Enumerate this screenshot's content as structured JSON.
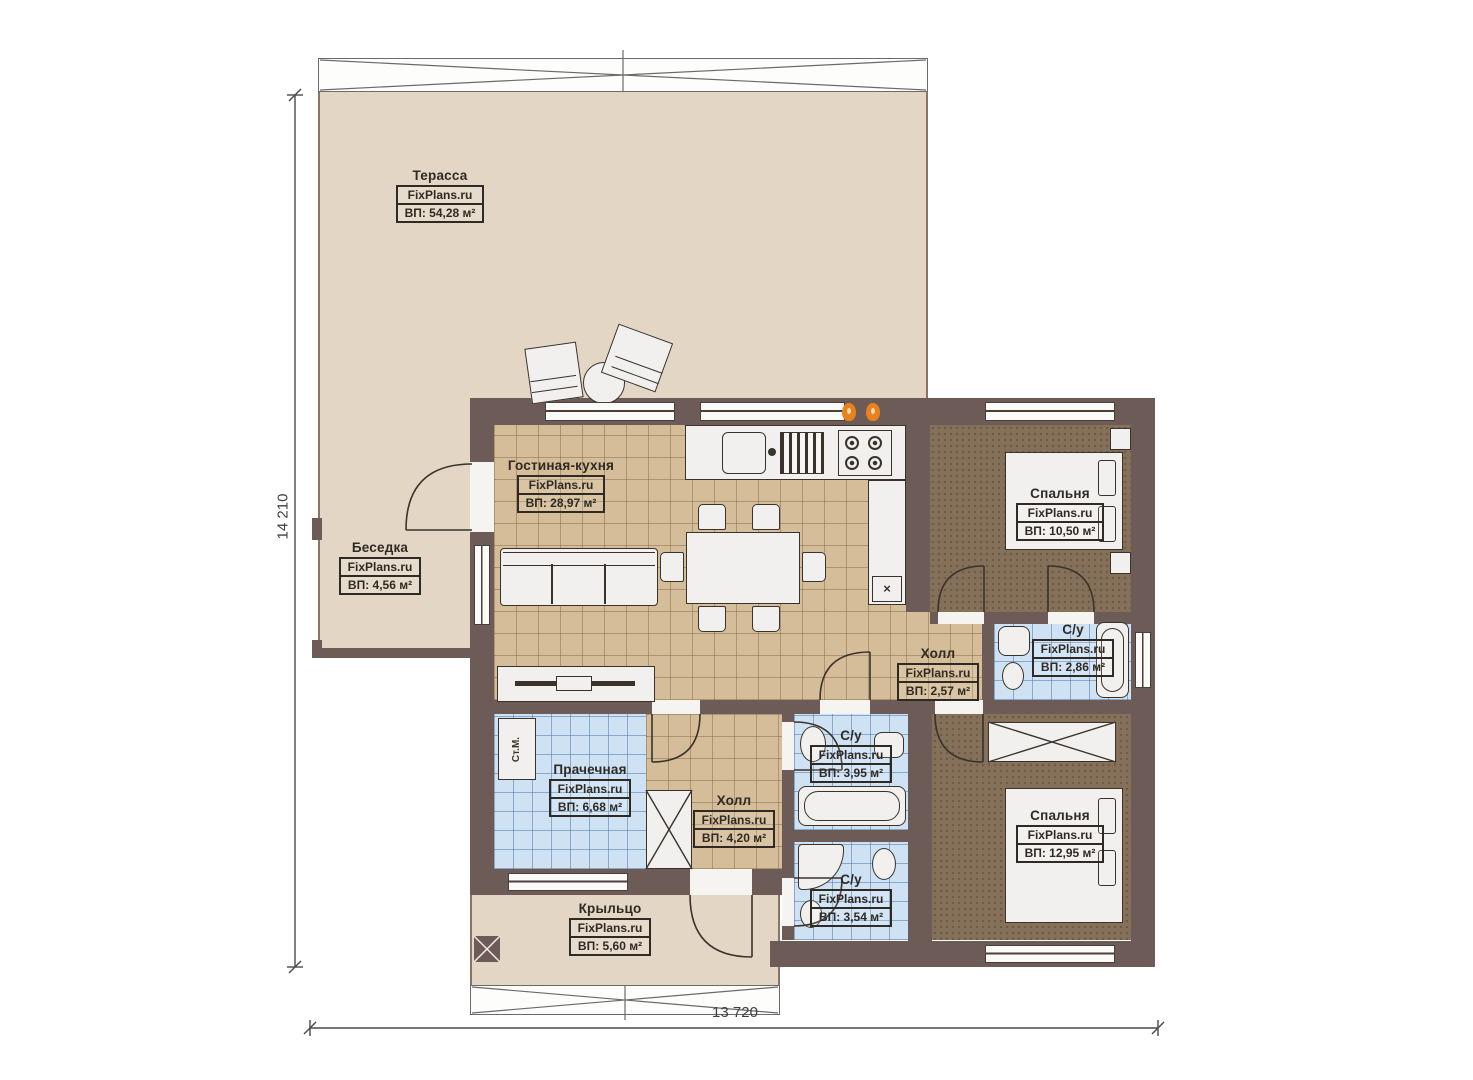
{
  "plan": {
    "dimensions": {
      "height_label": "14 210",
      "width_label": "13 720"
    },
    "rooms": {
      "terrace": {
        "name": "Терасса",
        "brand": "FixPlans.ru",
        "area": "ВП: 54,28 м²"
      },
      "gazebo": {
        "name": "Беседка",
        "brand": "FixPlans.ru",
        "area": "ВП: 4,56 м²"
      },
      "living_kitchen": {
        "name": "Гостиная-кухня",
        "brand": "FixPlans.ru",
        "area": "ВП: 28,97 м²"
      },
      "bedroom_top": {
        "name": "Спальня",
        "brand": "FixPlans.ru",
        "area": "ВП: 10,50 м²"
      },
      "hall_top": {
        "name": "Холл",
        "brand": "FixPlans.ru",
        "area": "ВП: 2,57 м²"
      },
      "bathroom_top": {
        "name": "С/у",
        "brand": "FixPlans.ru",
        "area": "ВП: 2,86 м²"
      },
      "laundry": {
        "name": "Прачечная",
        "brand": "FixPlans.ru",
        "area": "ВП: 6,68 м²"
      },
      "hall_bottom": {
        "name": "Холл",
        "brand": "FixPlans.ru",
        "area": "ВП: 4,20 м²"
      },
      "bathroom_mid": {
        "name": "С/у",
        "brand": "FixPlans.ru",
        "area": "ВП: 3,95 м²"
      },
      "bathroom_low": {
        "name": "С/у",
        "brand": "FixPlans.ru",
        "area": "ВП: 3,54 м²"
      },
      "bedroom_bottom": {
        "name": "Спальня",
        "brand": "FixPlans.ru",
        "area": "ВП: 12,95 м²"
      },
      "porch": {
        "name": "Крыльцо",
        "brand": "FixPlans.ru",
        "area": "ВП: 5,60 м²"
      }
    },
    "annotations": {
      "washing_machine": "Ст.М."
    },
    "colors": {
      "wall": "#6d5b57",
      "terrace_floor": "#e4d6c4",
      "living_floor": "#d4bd98",
      "bedroom_floor": "#85705a",
      "bathroom_floor": "#cfe2f4",
      "fixture": "#f1f0ee",
      "flame": "#e8821e",
      "label_ink": "#2f2a24"
    }
  }
}
